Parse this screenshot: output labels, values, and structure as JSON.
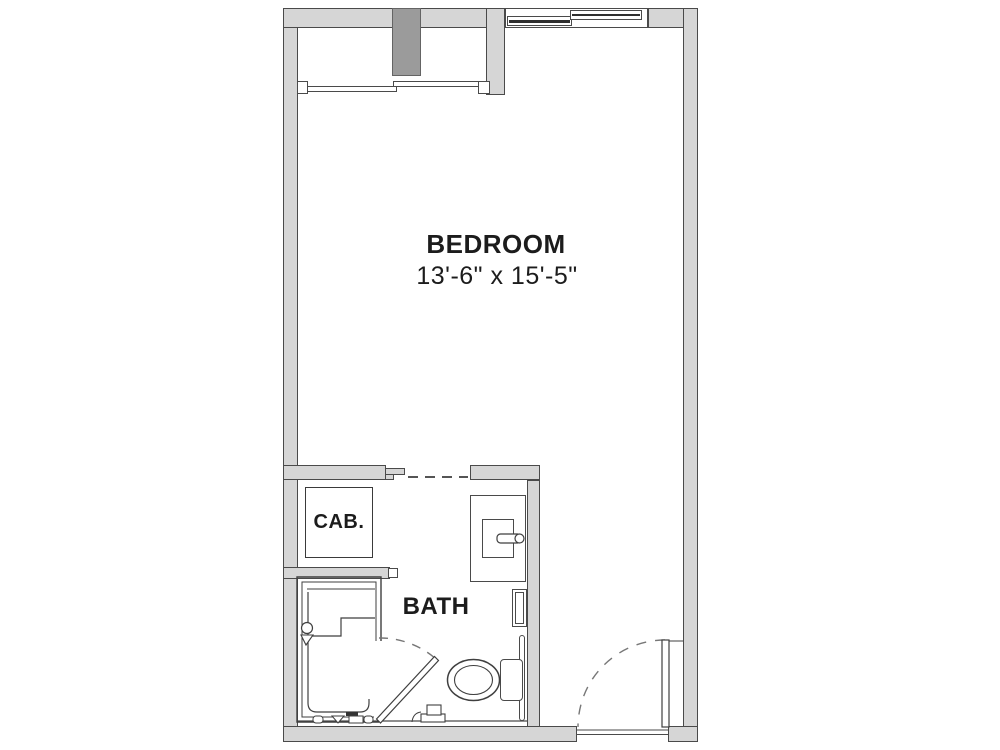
{
  "plan": {
    "type": "studio-unit-floor-plan",
    "background": "#ffffff"
  },
  "rooms": {
    "bedroom": {
      "name": "BEDROOM",
      "dimensions": "13'-6\" x 15'-5\""
    },
    "bath": {
      "name": "BATH"
    },
    "cabinet": {
      "name": "CAB."
    }
  },
  "fixtures": {
    "icons": [
      "closet-sliding-doors",
      "structural-column",
      "sliding-window",
      "cabinet-box",
      "sink-vanity",
      "faucet",
      "shelf-unit",
      "grab-bar",
      "toilet",
      "shower-stall",
      "shower-valve",
      "bath-swing-door",
      "entry-swing-door",
      "door-threshold",
      "cased-opening-dashed"
    ]
  },
  "colors": {
    "wall_fill": "#d6d6d6",
    "wall_outline": "#4a4a4a",
    "column_fill": "#9b9b9b",
    "fixture_outline": "#3f3f3f",
    "swing_arc": "#777777",
    "text": "#1c1c1c",
    "background": "#ffffff"
  }
}
